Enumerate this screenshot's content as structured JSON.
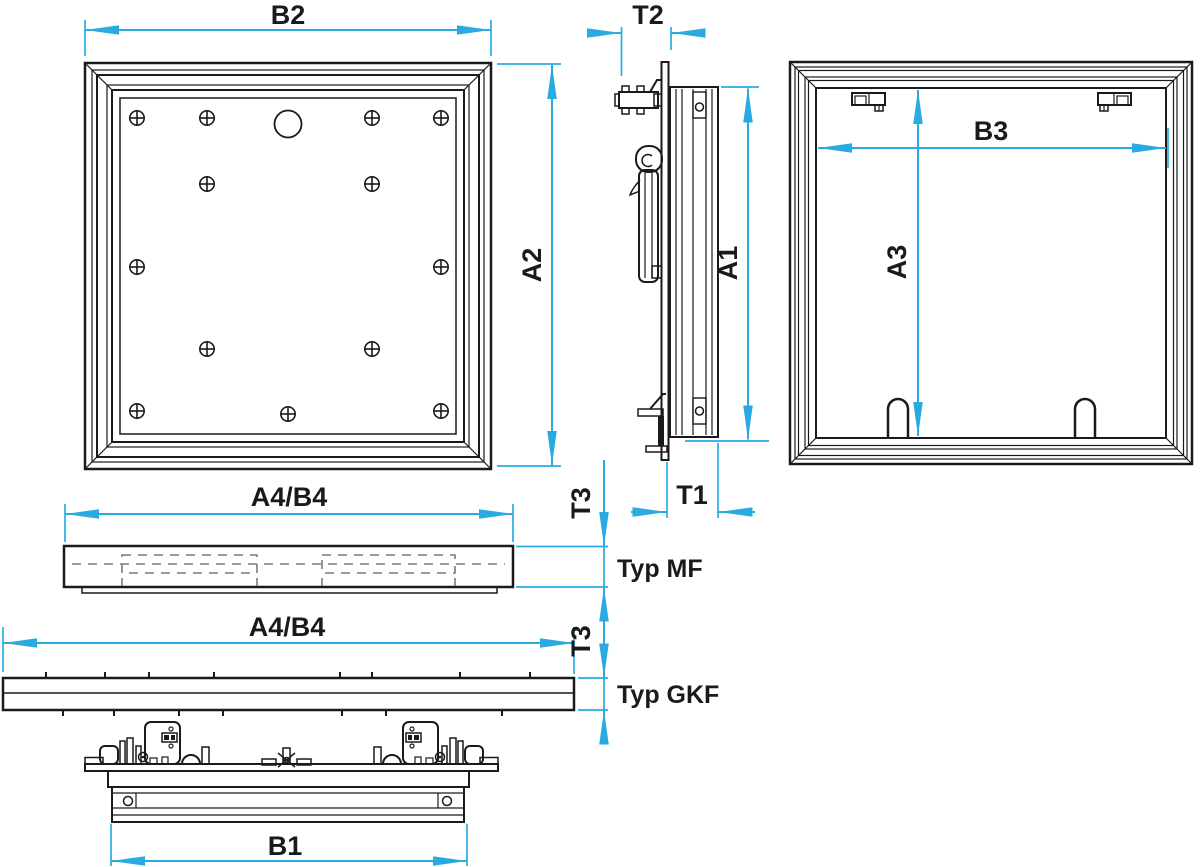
{
  "views": {
    "front": {
      "width_label": "B2",
      "height_label": "A2"
    },
    "side": {
      "depth_label": "T2",
      "height_label": "A1",
      "thickness_label": "T1"
    },
    "rear": {
      "width_label": "B3",
      "height_label": "A3"
    },
    "section_mf": {
      "width_label": "A4/B4",
      "thickness_label": "T3",
      "type_label": "Typ MF"
    },
    "section_gkf": {
      "width_label": "A4/B4",
      "thickness_label": "T3",
      "type_label": "Typ GKF"
    },
    "bottom": {
      "width_label": "B1"
    }
  },
  "colors": {
    "dimension": "#29abe2",
    "outline": "#1a1a1a",
    "hidden_line": "#7a7a7a",
    "background": "#ffffff"
  }
}
